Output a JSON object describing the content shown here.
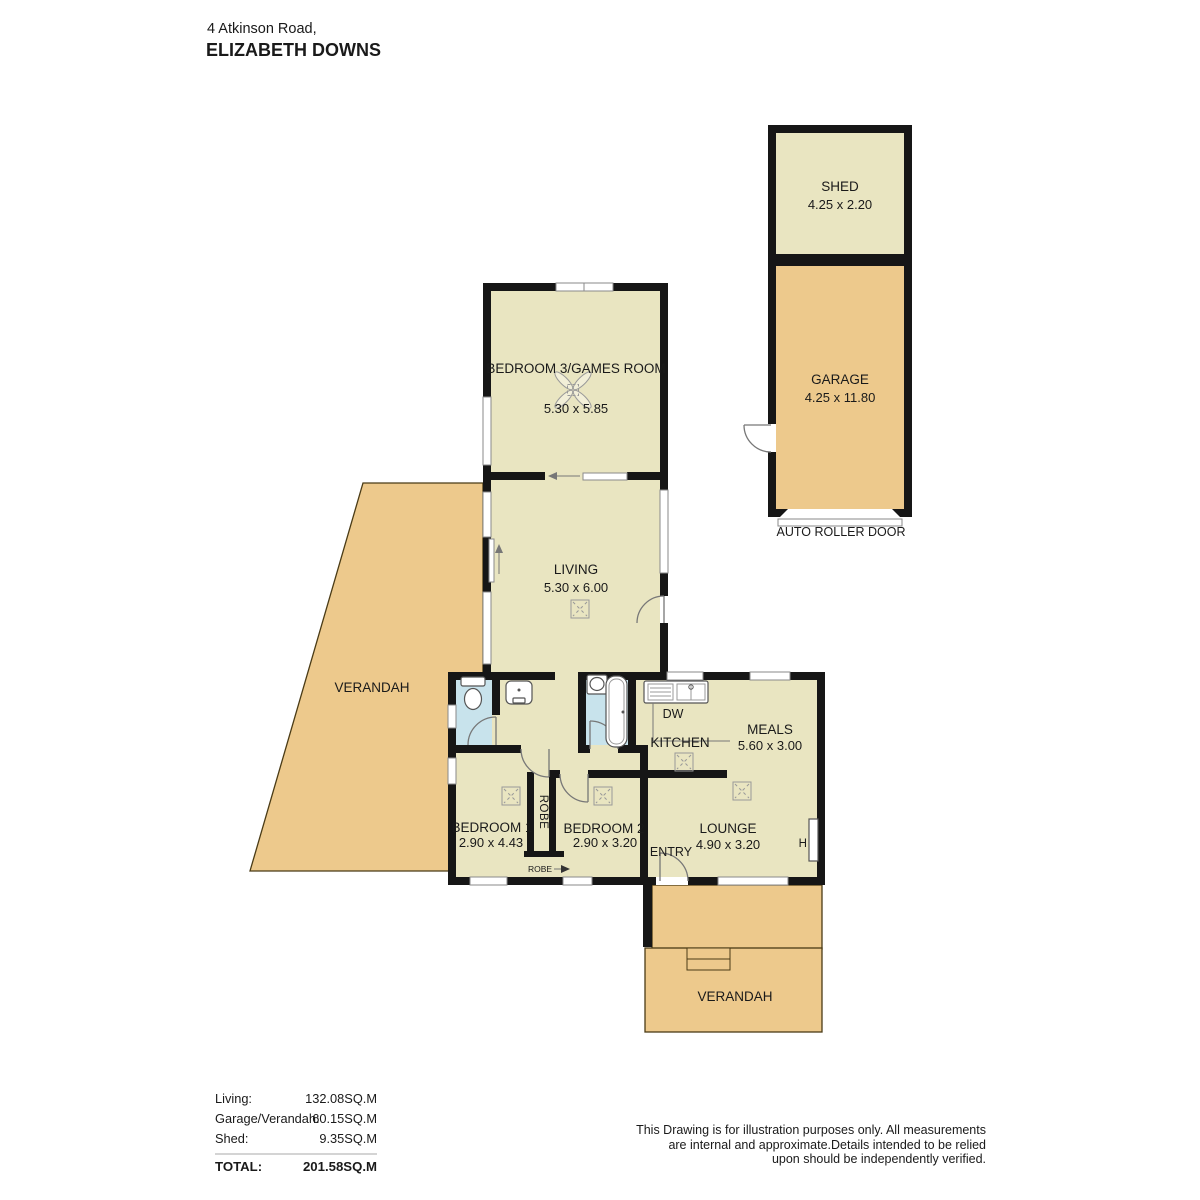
{
  "title": {
    "address_line1": "4 Atkinson Road,",
    "address_line2": "ELIZABETH DOWNS"
  },
  "rooms": {
    "shed": {
      "name": "SHED",
      "dims": "4.25 x 2.20"
    },
    "garage": {
      "name": "GARAGE",
      "dims": "4.25 x 11.80"
    },
    "auto_roller_door_label": "AUTO ROLLER DOOR",
    "bedroom3": {
      "name": "BEDROOM 3/GAMES ROOM",
      "dims": "5.30 x 5.85"
    },
    "living": {
      "name": "LIVING",
      "dims": "5.30 x 6.00"
    },
    "verandah_left": {
      "name": "VERANDAH"
    },
    "kitchen": {
      "name": "KITCHEN",
      "dishwasher_label": "DW"
    },
    "meals": {
      "name": "MEALS",
      "dims": "5.60 x 3.00"
    },
    "bedroom1": {
      "name": "BEDROOM 1",
      "dims": "2.90 x 4.43"
    },
    "bedroom2": {
      "name": "BEDROOM 2",
      "dims": "2.90 x 3.20"
    },
    "robe_tall_label": "ROBE",
    "robe_small_label": "ROBE",
    "entry": {
      "name": "ENTRY"
    },
    "lounge": {
      "name": "LOUNGE",
      "dims": "4.90 x 3.20"
    },
    "heater_label": "H",
    "verandah_bottom": {
      "name": "VERANDAH"
    }
  },
  "legend": {
    "rows": [
      {
        "label": "Living:",
        "value": "132.08SQ.M"
      },
      {
        "label": "Garage/Verandah:",
        "value": "60.15SQ.M"
      },
      {
        "label": "Shed:",
        "value": "9.35SQ.M"
      }
    ],
    "total_label": "TOTAL:",
    "total_value": "201.58SQ.M"
  },
  "disclaimer": {
    "line1": "This Drawing is for illustration purposes only. All measurements",
    "line2": "are internal and approximate.Details intended to be relied",
    "line3": "upon should be independently verified."
  },
  "colors": {
    "room_fill": "#e9e5c1",
    "verandah_fill": "#edc98c",
    "wet_area_fill": "#c8e3ec",
    "wall": "#161616",
    "background": "#ffffff"
  }
}
